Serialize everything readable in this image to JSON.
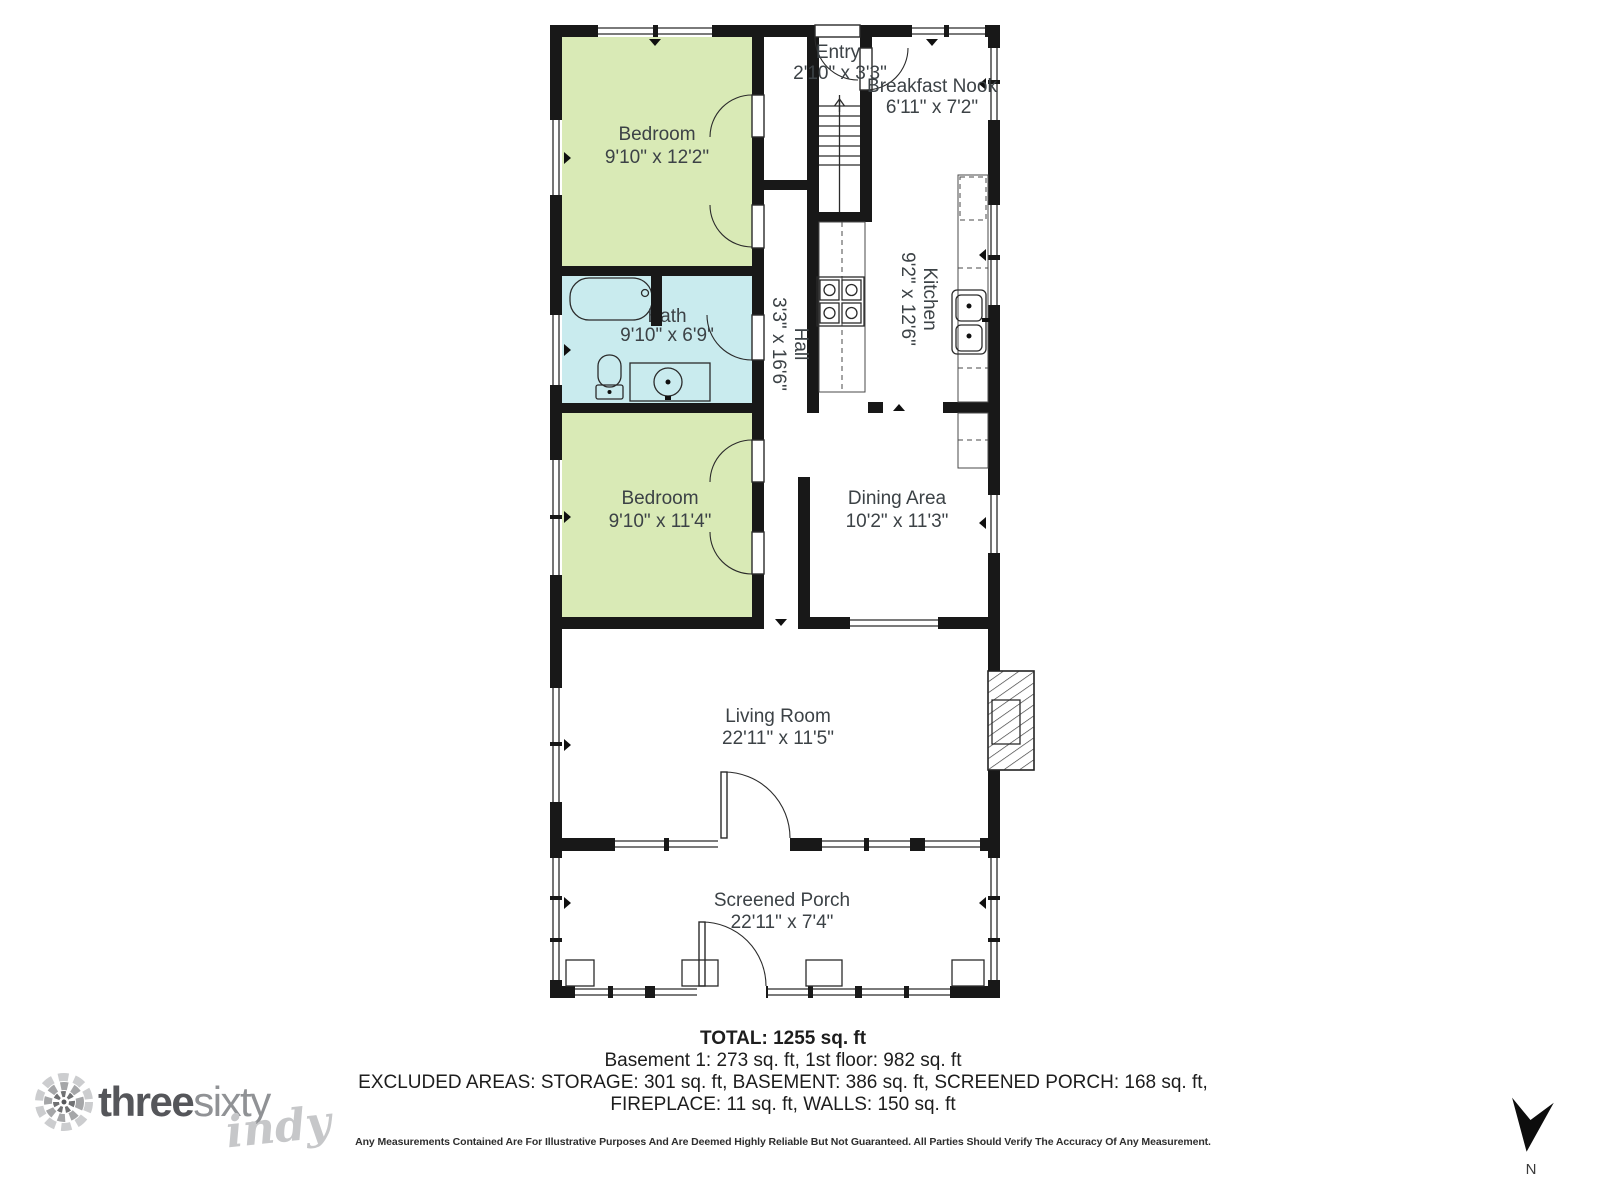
{
  "rooms": {
    "bedroom1": {
      "name": "Bedroom",
      "dims": "9'10\" x 12'2\""
    },
    "entry": {
      "name": "Entry",
      "dims": "2'10\" x 3'3\""
    },
    "breakfast_nook": {
      "name": "Breakfast Nook",
      "dims": "6'11\" x 7'2\""
    },
    "kitchen": {
      "name": "Kitchen",
      "dims": "9'2\" x 12'6\""
    },
    "bath": {
      "name": "Bath",
      "dims": "9'10\" x 6'9\""
    },
    "hall": {
      "name": "Hall",
      "dims": "3'3\" x 16'6\""
    },
    "bedroom2": {
      "name": "Bedroom",
      "dims": "9'10\" x 11'4\""
    },
    "dining": {
      "name": "Dining Area",
      "dims": "10'2\" x 11'3\""
    },
    "living": {
      "name": "Living Room",
      "dims": "22'11\" x 11'5\""
    },
    "porch": {
      "name": "Screened Porch",
      "dims": "22'11\" x 7'4\""
    }
  },
  "summary": {
    "total": "TOTAL: 1255 sq. ft",
    "floors": "Basement 1: 273 sq. ft, 1st floor: 982 sq. ft",
    "excluded1": "EXCLUDED AREAS: STORAGE: 301 sq. ft, BASEMENT: 386 sq. ft, SCREENED PORCH: 168 sq. ft,",
    "excluded2": "FIREPLACE: 11 sq. ft, WALLS: 150 sq. ft",
    "disclaimer": "Any Measurements Contained Are For Illustrative Purposes And Are Deemed Highly Reliable But Not Guaranteed. All Parties Should Verify The Accuracy Of Any Measurement."
  },
  "logo": {
    "word1": "three",
    "word2": "sixty",
    "script": "indy"
  },
  "compass": {
    "label": "N"
  },
  "icons": {
    "logo_mark": "threesixty-pinwheel",
    "compass_arrow": "south-pointing-arrow"
  },
  "colors": {
    "bedroom_fill": "#d9eab6",
    "bath_fill": "#c9ebee",
    "wall": "#181818",
    "label_text": "#3c4246"
  }
}
